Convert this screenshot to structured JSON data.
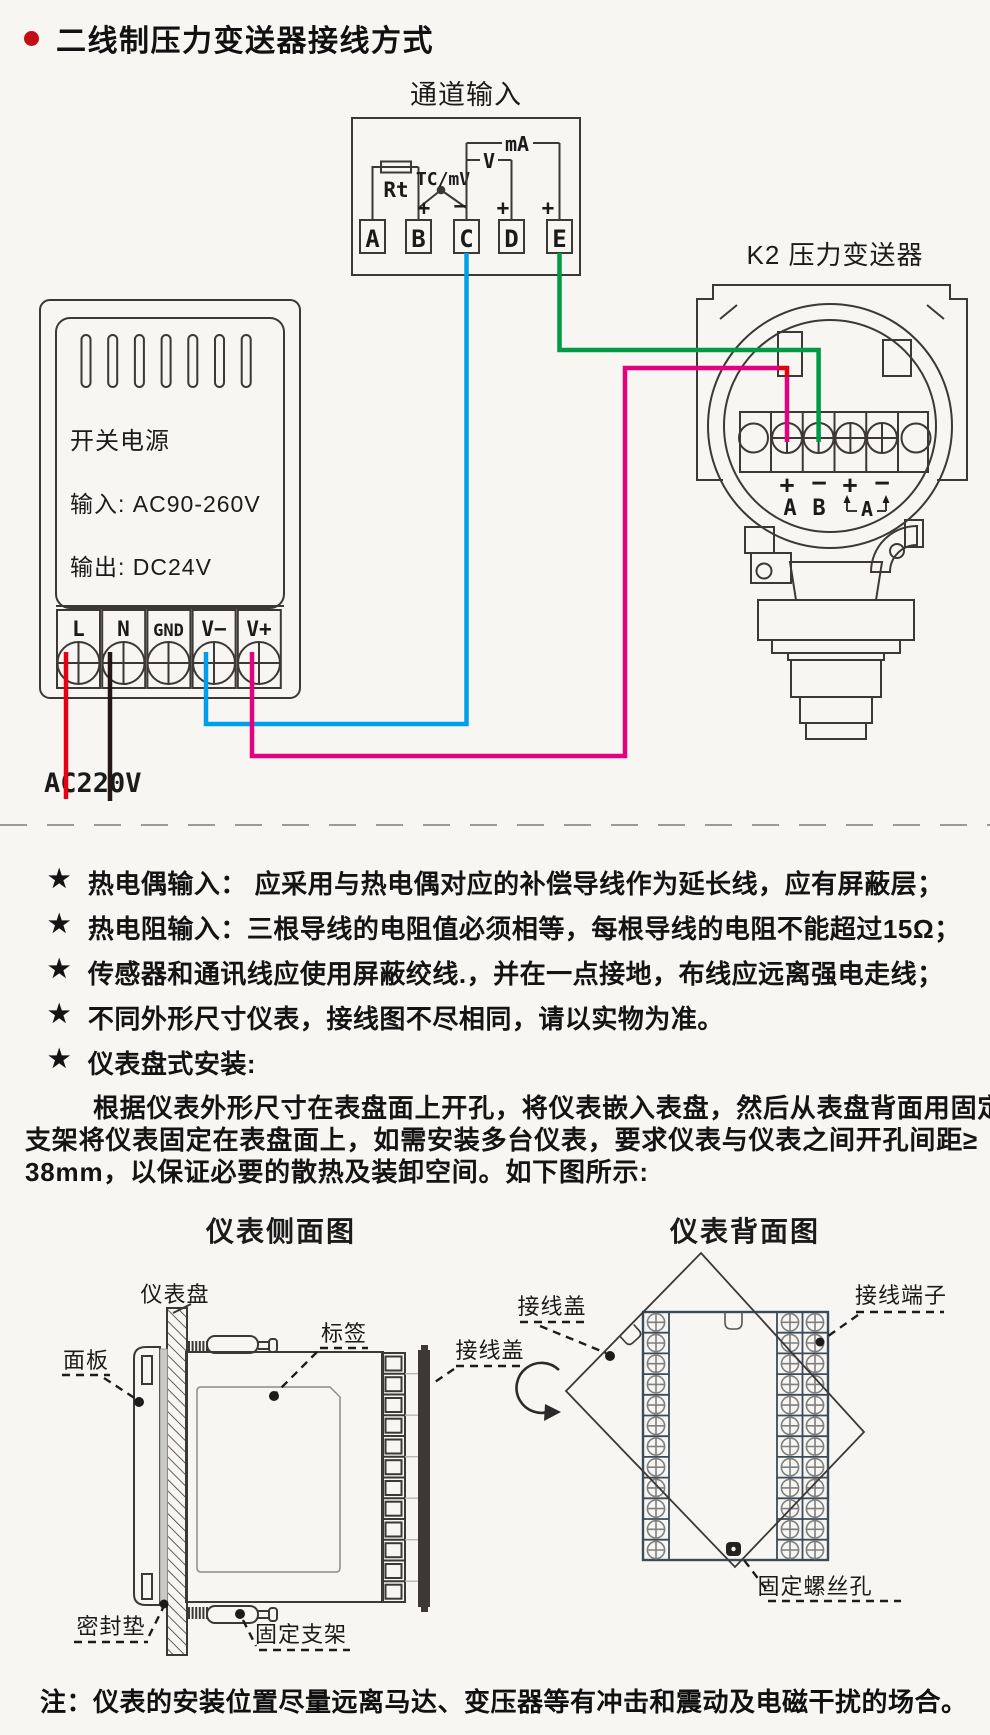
{
  "title": {
    "text": "二线制压力变送器接线方式"
  },
  "colors": {
    "accent_red": "#c30d15",
    "wire_red": "#e60012",
    "wire_black": "#231815",
    "wire_blue": "#00a0e9",
    "wire_magenta": "#e4007f",
    "wire_green": "#009944",
    "line": "#3b3836",
    "slate": "#3d4b57",
    "background": "#f7f6f3"
  },
  "wiring": {
    "channel": {
      "title": "通道输入",
      "terminals": [
        "A",
        "B",
        "C",
        "D",
        "E"
      ],
      "rt": "Rt",
      "tc": "TC/mV",
      "v": "V",
      "ma": "mA",
      "sign_plus": "+",
      "sign_minus": "−"
    },
    "transmitter": {
      "title": "K2 压力变送器",
      "polarity": [
        "+",
        "−",
        "+",
        "−"
      ],
      "ab": [
        "A",
        "B"
      ],
      "ammeter": "A"
    },
    "psu": {
      "name": "开关电源",
      "input": "输入: AC90-260V",
      "output": "输出: DC24V",
      "terminals": [
        "L",
        "N",
        "GND",
        "V−",
        "V+"
      ],
      "mains": "AC220V"
    }
  },
  "notes_star": "★",
  "notes": [
    "热电偶输入： 应采用与热电偶对应的补偿导线作为延长线，应有屏蔽层；",
    "热电阻输入：三根导线的电阻值必须相等，每根导线的电阻不能超过15Ω；",
    "传感器和通讯线应使用屏蔽绞线.，并在一点接地，布线应远离强电走线；",
    "不同外形尺寸仪表，接线图不尽相同，请以实物为准。",
    "仪表盘式安装:"
  ],
  "paragraph": [
    "根据仪表外形尺寸在表盘面上开孔，将仪表嵌入表盘，然后从表盘背面用固定",
    "支架将仪表固定在表盘面上，如需安装多台仪表，要求仪表与仪表之间开孔间距≥",
    "38mm，以保证必要的散热及装卸空间。如下图所示:"
  ],
  "side_view": {
    "title": "仪表侧面图",
    "panel": "仪表盘",
    "front": "面板",
    "tag": "标签",
    "cover": "接线盖",
    "gasket": "密封垫",
    "bracket": "固定支架"
  },
  "back_view": {
    "title": "仪表背面图",
    "cover": "接线盖",
    "terminal": "接线端子",
    "screw_hole": "固定螺丝孔"
  },
  "footnote": "注：仪表的安装位置尽量远离马达、变压器等有冲击和震动及电磁干扰的场合。"
}
